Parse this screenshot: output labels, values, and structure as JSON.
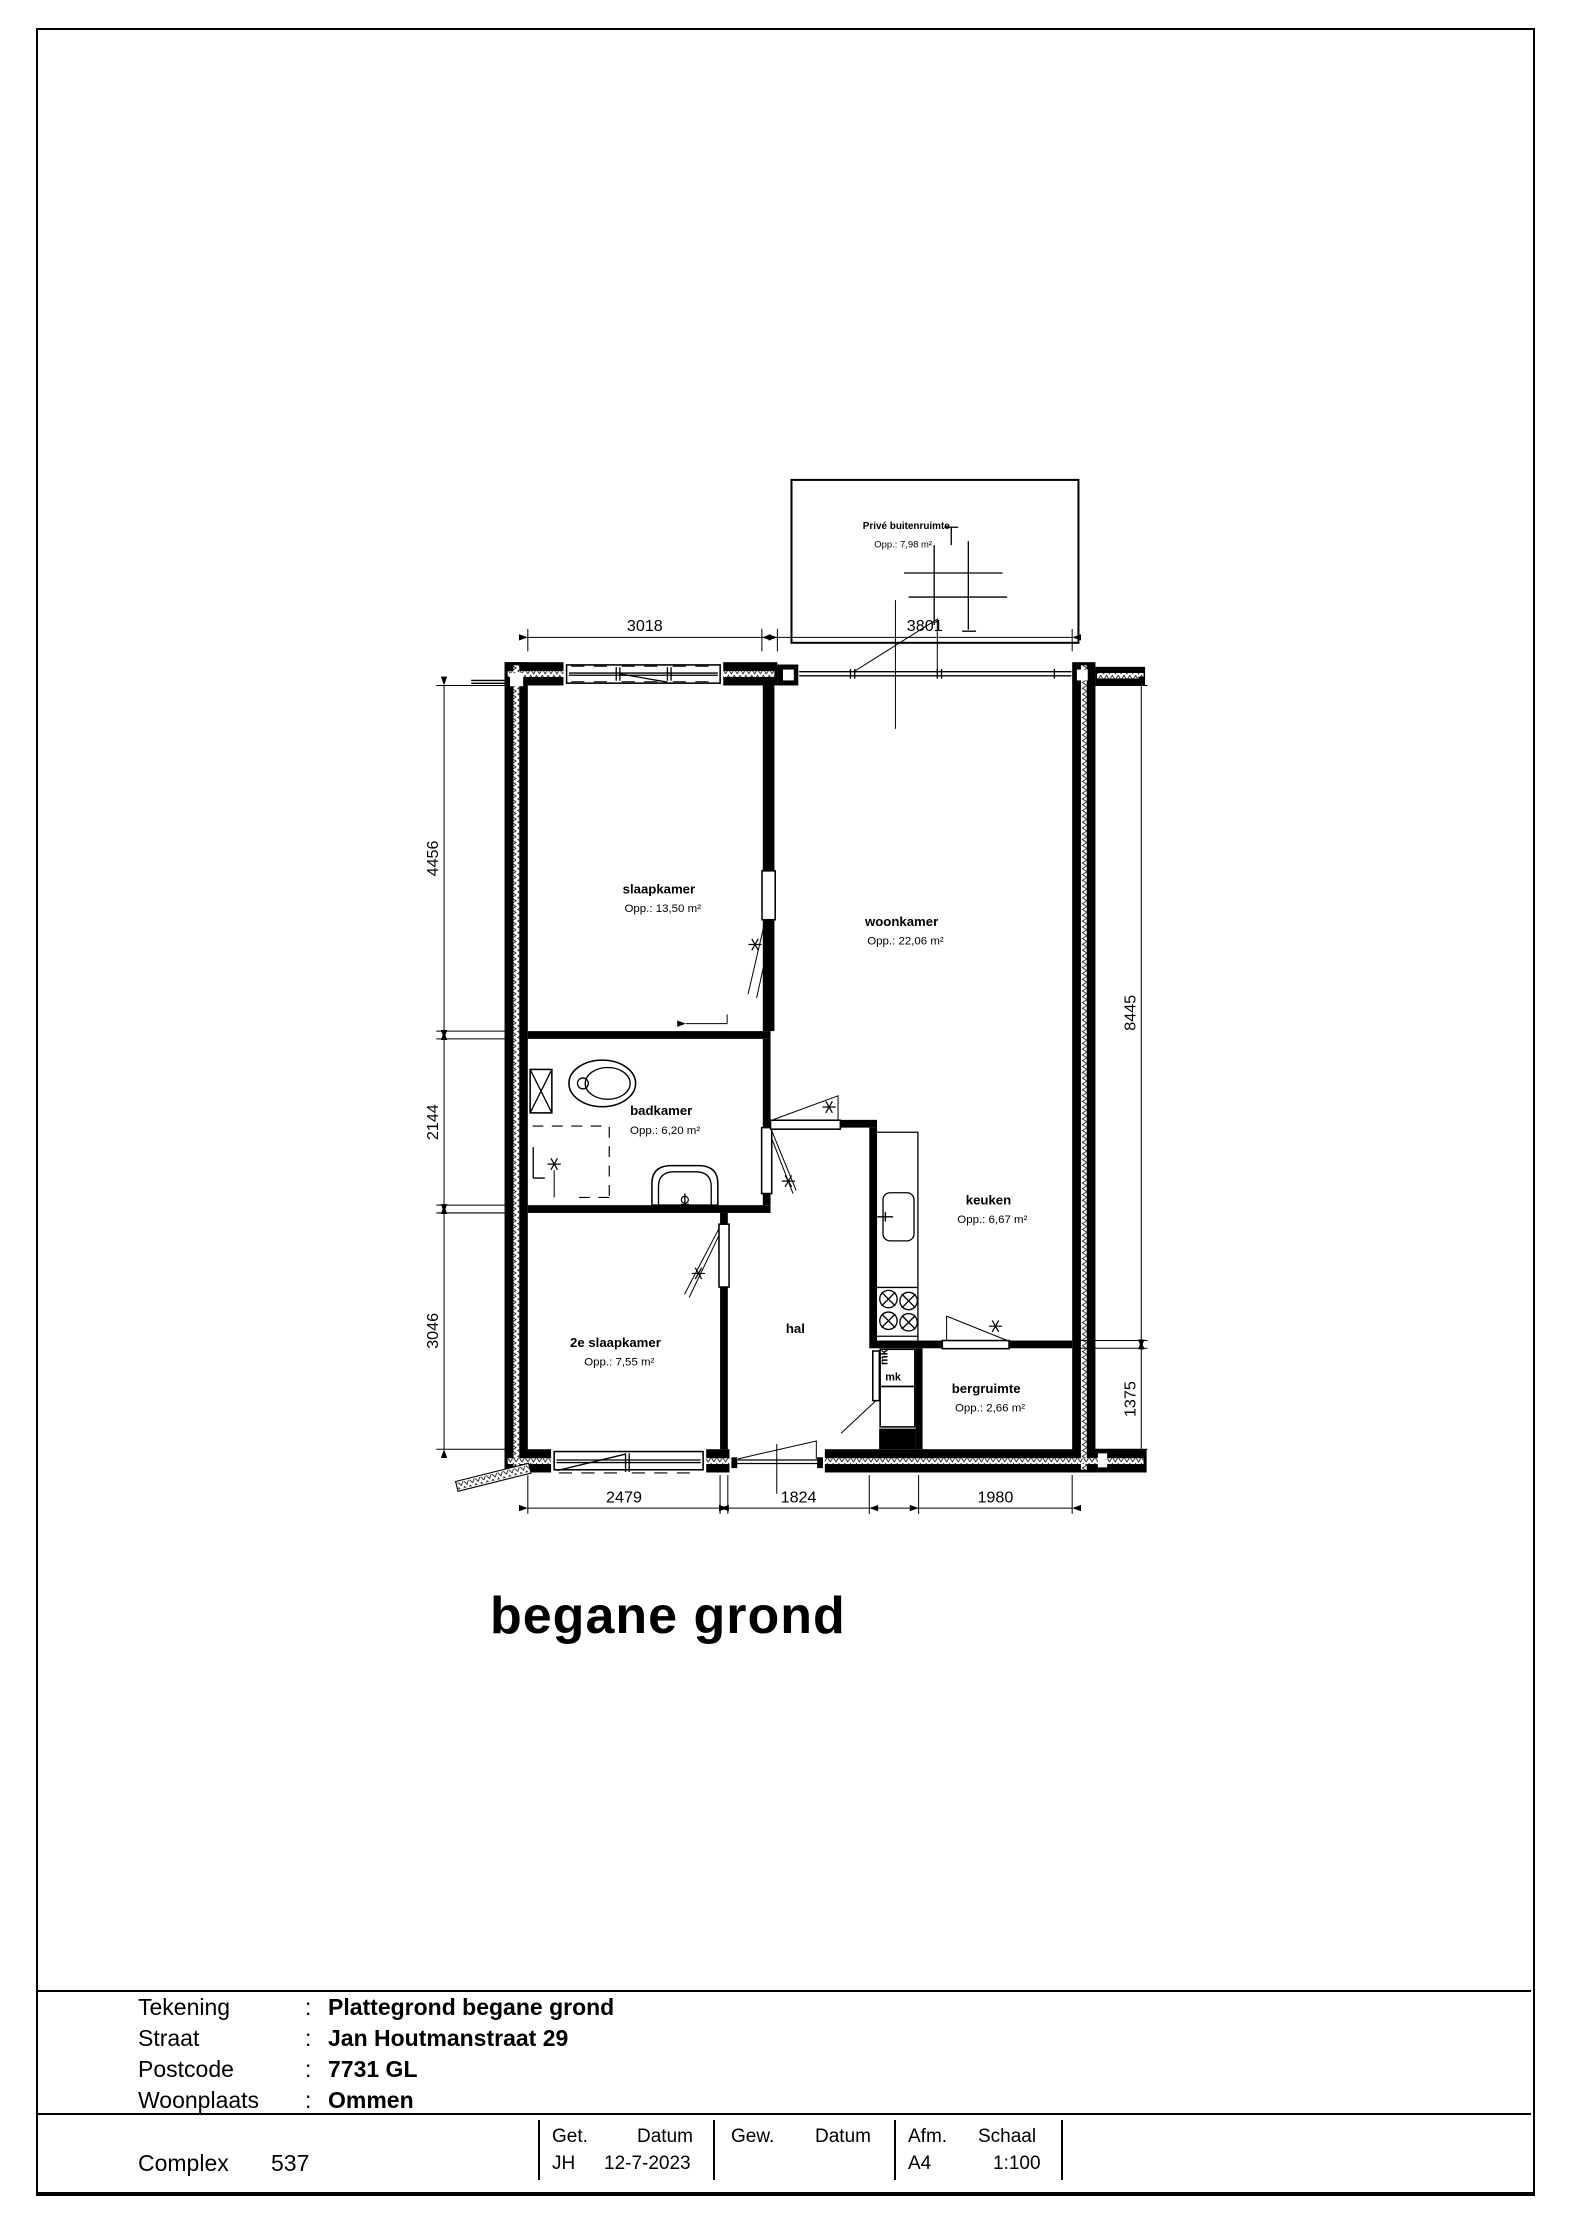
{
  "page": {
    "heading": "begane grond"
  },
  "plan": {
    "outdoor": {
      "name": "Privé buitenruimte",
      "area": "Opp.: 7,98 m²"
    },
    "rooms": [
      {
        "name": "slaapkamer",
        "area": "Opp.: 13,50 m²"
      },
      {
        "name": "woonkamer",
        "area": "Opp.: 22,06 m²"
      },
      {
        "name": "badkamer",
        "area": "Opp.: 6,20 m²"
      },
      {
        "name": "keuken",
        "area": "Opp.: 6,67 m²"
      },
      {
        "name": "hal",
        "area": ""
      },
      {
        "name": "2e slaapkamer",
        "area": "Opp.: 7,55 m²"
      },
      {
        "name": "bergruimte",
        "area": "Opp.: 2,66 m²"
      }
    ],
    "closets": {
      "mk_top": "mk",
      "mk_bottom": "mk"
    },
    "dims": {
      "top": [
        "3018",
        "3801"
      ],
      "left": [
        "4456",
        "2144",
        "3046"
      ],
      "right": [
        "8445",
        "1375"
      ],
      "bottom": [
        "2479",
        "1824",
        "1980"
      ]
    }
  },
  "titleblock": {
    "fields": [
      {
        "label": "Tekening",
        "sep": ":",
        "value": "Plattegrond begane grond"
      },
      {
        "label": "Straat",
        "sep": ":",
        "value": "Jan Houtmanstraat 29"
      },
      {
        "label": "Postcode",
        "sep": ":",
        "value": "7731 GL"
      },
      {
        "label": "Woonplaats",
        "sep": ":",
        "value": "Ommen"
      }
    ],
    "complex": {
      "label": "Complex",
      "value": "537"
    },
    "meta": {
      "get_label": "Get.",
      "get_value": "JH",
      "datum1_label": "Datum",
      "datum1_value": "12-7-2023",
      "gew_label": "Gew.",
      "datum2_label": "Datum",
      "afm_label": "Afm.",
      "afm_value": "A4",
      "schaal_label": "Schaal",
      "schaal_value": "1:100"
    }
  }
}
